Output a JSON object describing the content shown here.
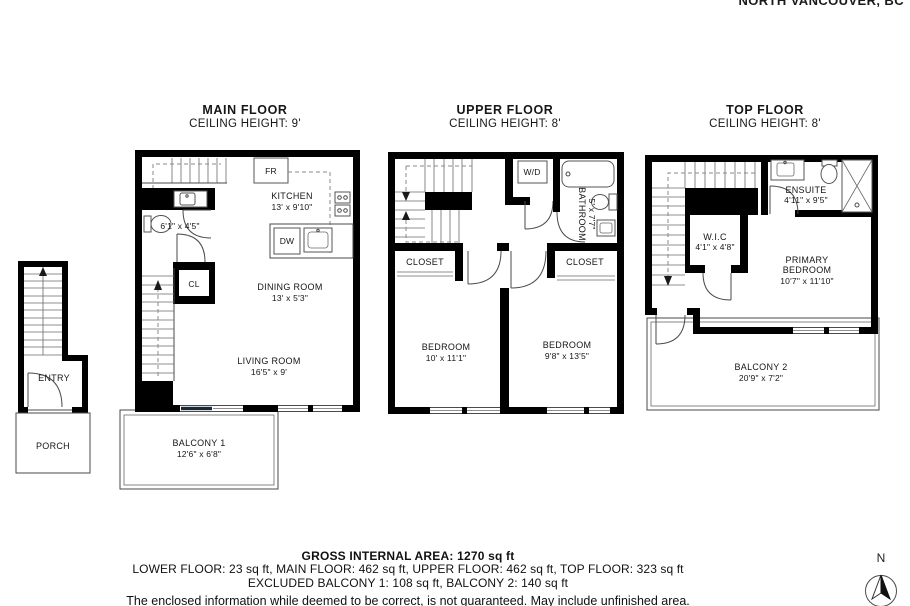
{
  "header": {
    "address": "NORTH VANCOUVER, BC"
  },
  "floors": {
    "main": {
      "title": "MAIN FLOOR",
      "ceiling": "CEILING HEIGHT: 9'",
      "kitchen": {
        "name": "KITCHEN",
        "dims": "13' x 9'10\""
      },
      "dining": {
        "name": "DINING ROOM",
        "dims": "13' x 5'3\""
      },
      "living": {
        "name": "LIVING ROOM",
        "dims": "16'5\" x 9'"
      },
      "bathroom": {
        "dims": "6'1\" x 4'5\""
      },
      "fridge": "FR",
      "dishwasher": "DW",
      "closet": "CL",
      "balcony": {
        "name": "BALCONY 1",
        "dims": "12'6\" x 6'8\""
      }
    },
    "upper": {
      "title": "UPPER FLOOR",
      "ceiling": "CEILING HEIGHT: 8'",
      "washer_dryer": "W/D",
      "bathroom": {
        "name": "BATHROOM",
        "dims": "5' x 7'7\""
      },
      "closet_left": "CLOSET",
      "closet_right": "CLOSET",
      "bedroom_left": {
        "name": "BEDROOM",
        "dims": "10' x 11'1\""
      },
      "bedroom_right": {
        "name": "BEDROOM",
        "dims": "9'8\" x 13'5\""
      }
    },
    "top": {
      "title": "TOP FLOOR",
      "ceiling": "CEILING HEIGHT: 8'",
      "ensuite": {
        "name": "ENSUITE",
        "dims": "4'11\" x 9'5\""
      },
      "wic": {
        "name": "W.I.C",
        "dims": "4'1\" x 4'8\""
      },
      "primary": {
        "name_line1": "PRIMARY",
        "name_line2": "BEDROOM",
        "dims": "10'7\" x 11'10\""
      },
      "balcony": {
        "name": "BALCONY 2",
        "dims": "20'9\" x 7'2\""
      }
    }
  },
  "entry": {
    "entry": "ENTRY",
    "porch": "PORCH"
  },
  "footer": {
    "gross": "GROSS INTERNAL AREA: 1270 sq ft",
    "floor_areas": "LOWER FLOOR: 23 sq ft, MAIN FLOOR: 462 sq ft, UPPER FLOOR: 462 sq ft, TOP FLOOR: 323 sq ft",
    "excluded": "EXCLUDED BALCONY 1: 108 sq ft, BALCONY 2: 140 sq ft",
    "disclaimer": "The enclosed information while deemed to be correct, is not guaranteed. May include unfinished area."
  },
  "compass": {
    "north": "N"
  }
}
